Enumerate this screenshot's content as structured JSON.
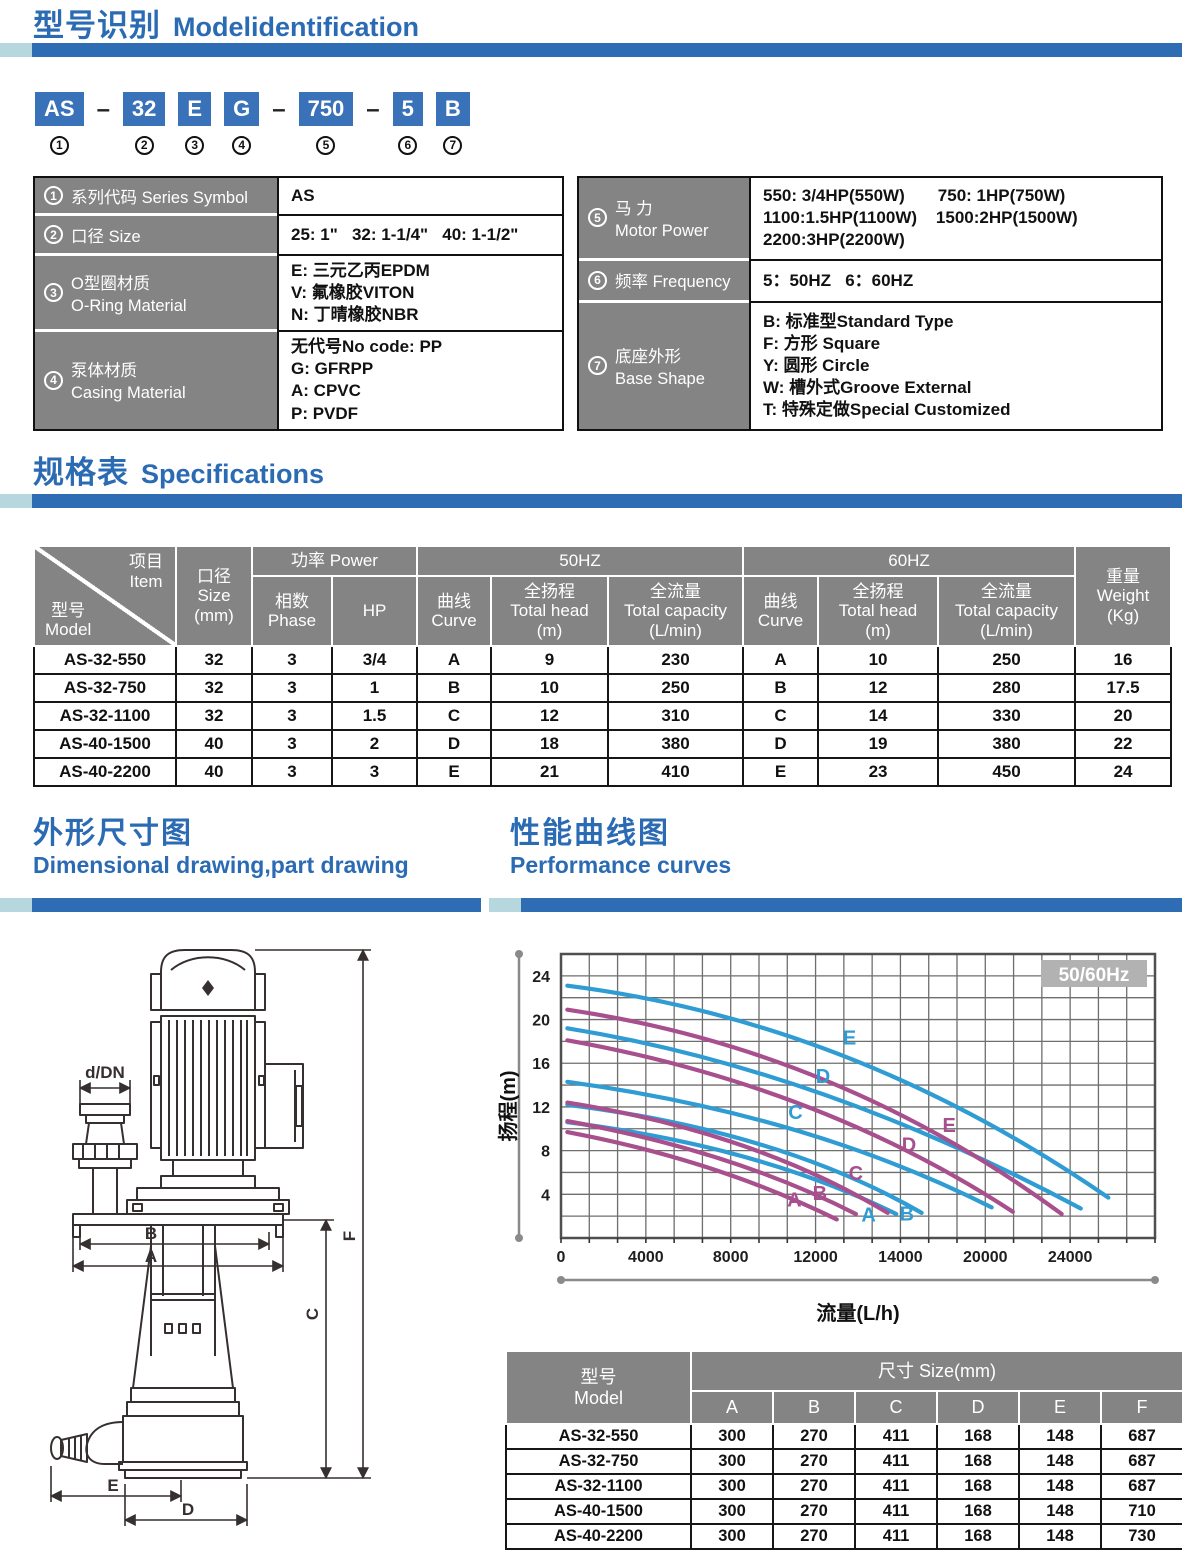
{
  "model_section": {
    "title_zh": "型号识别",
    "title_en": "Modelidentification",
    "code_boxes": [
      "AS",
      "32",
      "E",
      "G",
      "750",
      "5",
      "B"
    ],
    "code_nums": [
      "1",
      "2",
      "3",
      "4",
      "5",
      "6",
      "7"
    ],
    "dash": "–",
    "id_rows_left": [
      {
        "num": "1",
        "label": [
          "系列代码 Series Symbol"
        ],
        "value": [
          "AS"
        ]
      },
      {
        "num": "2",
        "label": [
          "口径 Size"
        ],
        "value": [
          "25: 1\"   32: 1-1/4\"   40: 1-1/2\""
        ]
      },
      {
        "num": "3",
        "label": [
          "O型圈材质",
          "O-Ring Material"
        ],
        "value": [
          "E: 三元乙丙EPDM",
          "V: 氟橡胶VITON",
          "N: 丁晴橡胶NBR"
        ]
      },
      {
        "num": "4",
        "label": [
          "泵体材质",
          "Casing Material"
        ],
        "value": [
          "无代号No code: PP",
          "G: GFRPP",
          "A: CPVC",
          "P: PVDF"
        ]
      }
    ],
    "id_rows_right": [
      {
        "num": "5",
        "label": [
          "马 力",
          "Motor Power"
        ],
        "value": [
          "550: 3/4HP(550W)       750: 1HP(750W)",
          "1100:1.5HP(1100W)    1500:2HP(1500W)",
          "2200:3HP(2200W)"
        ]
      },
      {
        "num": "6",
        "label": [
          "频率 Frequency"
        ],
        "value": [
          "5：50HZ   6：60HZ"
        ]
      },
      {
        "num": "7",
        "label": [
          "底座外形",
          "Base Shape"
        ],
        "value": [
          "B: 标准型Standard Type",
          "F: 方形 Square",
          "Y: 圆形 Circle",
          "W: 槽外式Groove External",
          "T: 特殊定做Special Customized"
        ]
      }
    ]
  },
  "specs": {
    "title_zh": "规格表",
    "title_en": "Specifications",
    "header": {
      "corner_top": "项目",
      "corner_top2": "Item",
      "corner_bot": "型号",
      "corner_bot2": "Model",
      "size": [
        "口径",
        "Size",
        "(mm)"
      ],
      "power": "功率 Power",
      "phase": [
        "相数",
        "Phase"
      ],
      "hp": "HP",
      "hz50": "50HZ",
      "hz60": "60HZ",
      "curve": [
        "曲线",
        "Curve"
      ],
      "head": [
        "全扬程",
        "Total head",
        "(m)"
      ],
      "capacity": [
        "全流量",
        "Total capacity",
        "(L/min)"
      ],
      "weight": [
        "重量",
        "Weight",
        "(Kg)"
      ]
    },
    "rows": [
      [
        "AS-32-550",
        "32",
        "3",
        "3/4",
        "A",
        "9",
        "230",
        "A",
        "10",
        "250",
        "16"
      ],
      [
        "AS-32-750",
        "32",
        "3",
        "1",
        "B",
        "10",
        "250",
        "B",
        "12",
        "280",
        "17.5"
      ],
      [
        "AS-32-1100",
        "32",
        "3",
        "1.5",
        "C",
        "12",
        "310",
        "C",
        "14",
        "330",
        "20"
      ],
      [
        "AS-40-1500",
        "40",
        "3",
        "2",
        "D",
        "18",
        "380",
        "D",
        "19",
        "380",
        "22"
      ],
      [
        "AS-40-2200",
        "40",
        "3",
        "3",
        "E",
        "21",
        "410",
        "E",
        "23",
        "450",
        "24"
      ]
    ]
  },
  "dims": {
    "title_zh": "外形尺寸图",
    "title_en": "Dimensional drawing,part drawing",
    "labels": {
      "flange": "d/DN",
      "a": "A",
      "b": "B",
      "c": "C",
      "d": "D",
      "e": "E",
      "f": "F"
    }
  },
  "perf": {
    "title_zh": "性能曲线图",
    "title_en": "Performance curves"
  },
  "chart_data": {
    "type": "line",
    "badge": "50/60Hz",
    "xlabel": "流量(L/h)",
    "ylabel": "扬程(m)",
    "xmax": 28000,
    "ymax": 26,
    "x_grid_divisions": 21,
    "y_grid_divisions": 13,
    "x_ticks": [
      {
        "v": 0,
        "label": "0"
      },
      {
        "v": 4000,
        "label": "4000"
      },
      {
        "v": 8000,
        "label": "8000"
      },
      {
        "v": 12000,
        "label": "12000"
      },
      {
        "v": 16000,
        "label": "14000"
      },
      {
        "v": 20000,
        "label": "20000"
      },
      {
        "v": 24000,
        "label": "24000"
      }
    ],
    "y_ticks": [
      4,
      8,
      12,
      16,
      20,
      24
    ],
    "colors": {
      "60Hz": "#2f9cd3",
      "50Hz": "#a84f8d"
    },
    "series": [
      {
        "name": "E",
        "freq": "60Hz",
        "points": [
          [
            300,
            23.1
          ],
          [
            13400,
            16.6
          ],
          [
            25800,
            3.7
          ]
        ],
        "label_at": [
          13600,
          17.7
        ]
      },
      {
        "name": "D",
        "freq": "60Hz",
        "points": [
          [
            300,
            19.2
          ],
          [
            12300,
            13.2
          ],
          [
            24500,
            2.7
          ]
        ],
        "label_at": [
          12350,
          14.2
        ]
      },
      {
        "name": "C",
        "freq": "60Hz",
        "points": [
          [
            300,
            14.3
          ],
          [
            11000,
            9.9
          ],
          [
            20300,
            2.8
          ]
        ],
        "label_at": [
          11050,
          10.9
        ]
      },
      {
        "name": "B",
        "freq": "60Hz",
        "points": [
          [
            300,
            12.2
          ],
          [
            9500,
            8.5
          ],
          [
            17000,
            2.3
          ]
        ],
        "label_at": [
          16300,
          1.6
        ]
      },
      {
        "name": "A",
        "freq": "60Hz",
        "points": [
          [
            300,
            10.6
          ],
          [
            8700,
            7.4
          ],
          [
            15800,
            2.2
          ]
        ],
        "label_at": [
          14500,
          1.5
        ]
      },
      {
        "name": "E",
        "freq": "50Hz",
        "points": [
          [
            300,
            20.9
          ],
          [
            12500,
            14.4
          ],
          [
            23600,
            2.2
          ]
        ],
        "label_at": [
          18300,
          9.7
        ]
      },
      {
        "name": "D",
        "freq": "50Hz",
        "points": [
          [
            300,
            18.1
          ],
          [
            11500,
            12.1
          ],
          [
            21300,
            2.4
          ]
        ],
        "label_at": [
          16400,
          7.9
        ]
      },
      {
        "name": "C",
        "freq": "50Hz",
        "points": [
          [
            300,
            12.4
          ],
          [
            8500,
            8.5
          ],
          [
            15400,
            2.3
          ]
        ],
        "label_at": [
          13900,
          5.3
        ]
      },
      {
        "name": "B",
        "freq": "50Hz",
        "points": [
          [
            300,
            10.7
          ],
          [
            7600,
            7.2
          ],
          [
            13900,
            2.2
          ]
        ],
        "label_at": [
          12200,
          3.5
        ]
      },
      {
        "name": "A",
        "freq": "50Hz",
        "points": [
          [
            300,
            9.7
          ],
          [
            7000,
            6.4
          ],
          [
            13000,
            1.7
          ]
        ],
        "label_at": [
          11000,
          2.9
        ]
      }
    ]
  },
  "size_table": {
    "header": {
      "model": [
        "型号",
        "Model"
      ],
      "size": "尺寸 Size(mm)",
      "cols": [
        "A",
        "B",
        "C",
        "D",
        "E",
        "F"
      ]
    },
    "rows": [
      [
        "AS-32-550",
        "300",
        "270",
        "411",
        "168",
        "148",
        "687"
      ],
      [
        "AS-32-750",
        "300",
        "270",
        "411",
        "168",
        "148",
        "687"
      ],
      [
        "AS-32-1100",
        "300",
        "270",
        "411",
        "168",
        "148",
        "687"
      ],
      [
        "AS-40-1500",
        "300",
        "270",
        "411",
        "168",
        "148",
        "710"
      ],
      [
        "AS-40-2200",
        "300",
        "270",
        "411",
        "168",
        "148",
        "730"
      ]
    ]
  }
}
